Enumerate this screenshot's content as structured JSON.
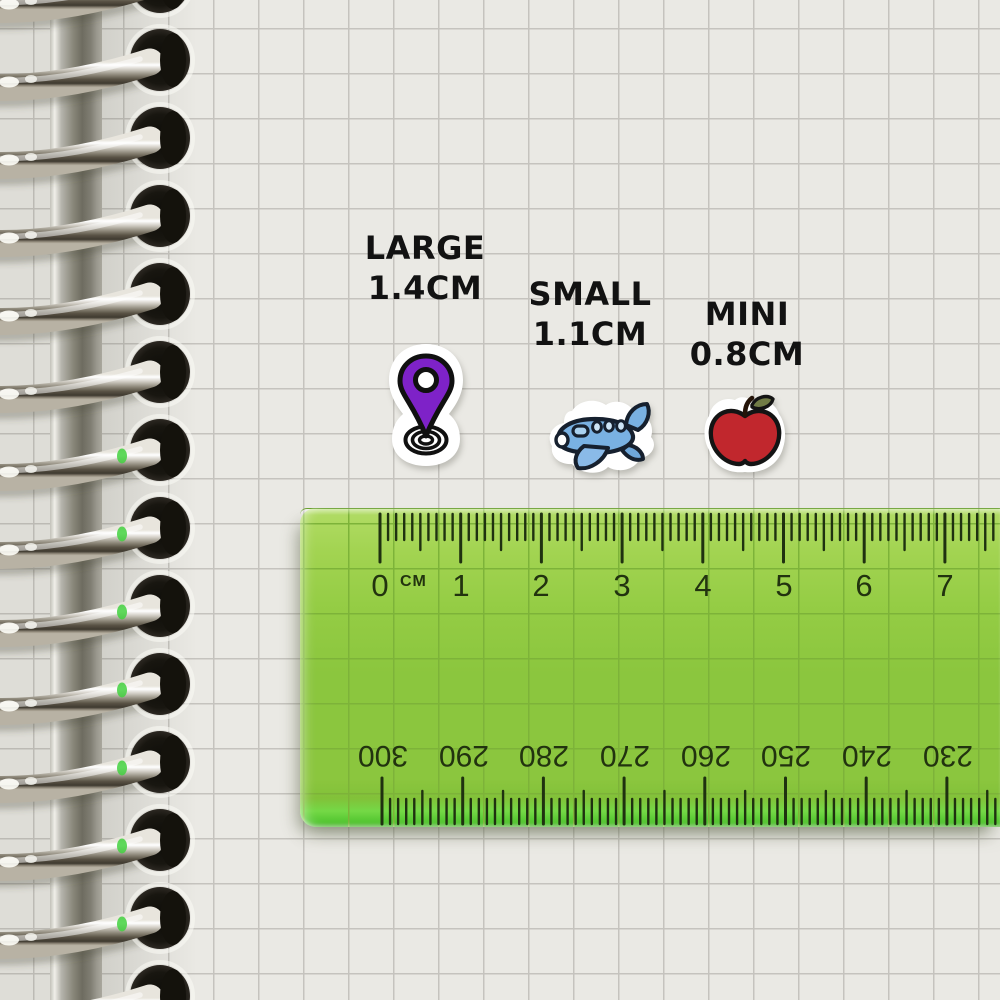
{
  "scene": {
    "description": "Photo of a spiral-bound notebook with grid paper; three die-cut sticker size samples shown above a transparent green ruler"
  },
  "size_labels": [
    {
      "label": "LARGE",
      "size": "1.4CM"
    },
    {
      "label": "SMALL",
      "size": "1.1CM"
    },
    {
      "label": "MINI",
      "size": "0.8CM"
    }
  ],
  "stickers": [
    {
      "name": "location-pin-sticker",
      "color": "#7e22c8"
    },
    {
      "name": "airplane-sticker",
      "color": "#79b1e2"
    },
    {
      "name": "apple-sticker",
      "color": "#c1272d"
    }
  ],
  "ruler": {
    "unit": "CM",
    "top_scale": [
      "0",
      "1",
      "2",
      "3",
      "4",
      "5",
      "6",
      "7"
    ],
    "bottom_scale": [
      "300",
      "290",
      "280",
      "270",
      "260",
      "250",
      "240",
      "230"
    ],
    "body_color": "#8bc63e",
    "tick_color": "#1f3110"
  },
  "notebook": {
    "paper_color": "#eae9e4",
    "grid_color": "#c5c3be",
    "binding": "silver-spiral-rings"
  }
}
